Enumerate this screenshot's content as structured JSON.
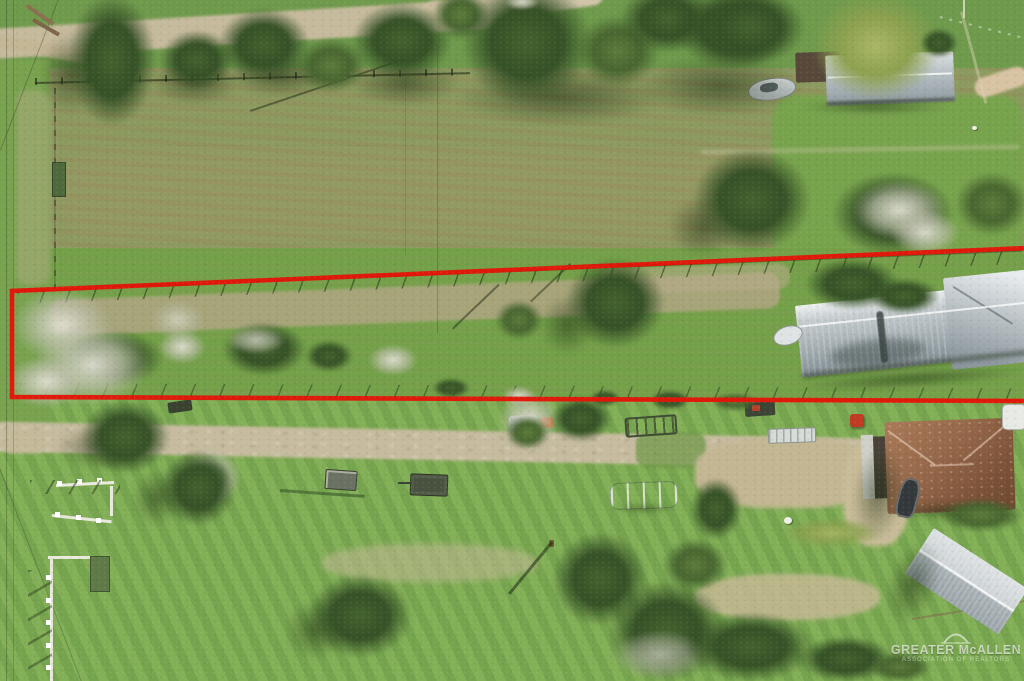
{
  "title": "Aerial drone photo of rural acreage with outlined parcel for sale",
  "watermark": {
    "brand": "GREATER McALLEN",
    "tagline": "ASSOCIATION OF REALTORS",
    "icon": "arch-logo-icon"
  },
  "boundary": {
    "color": "#e41408",
    "stroke_width": "4.6",
    "shape": "long narrow parcel outlined in red, spanning full image width"
  },
  "palette": {
    "grass": "#7aa24f",
    "plowed_field": "#8c9a60",
    "dirt_road": "#c6bb9e",
    "tree_dark": "#35512a",
    "metal_roof_gray": "#c3cacd",
    "house_roof_brown": "#8a5a40",
    "boundary_red": "#e41408"
  },
  "scene": {
    "objects": [
      "plowed-field",
      "outlined-parcel",
      "dirt-road",
      "farmhouse-metal-roof",
      "long-metal-barn",
      "brown-hip-roof-house",
      "gray-gable-shed",
      "white-camper-trailer",
      "boat-on-trailer",
      "utility-trailers",
      "blue-car",
      "white-cattle-pens",
      "tree-row",
      "dry-brush",
      "utility-lines"
    ]
  }
}
